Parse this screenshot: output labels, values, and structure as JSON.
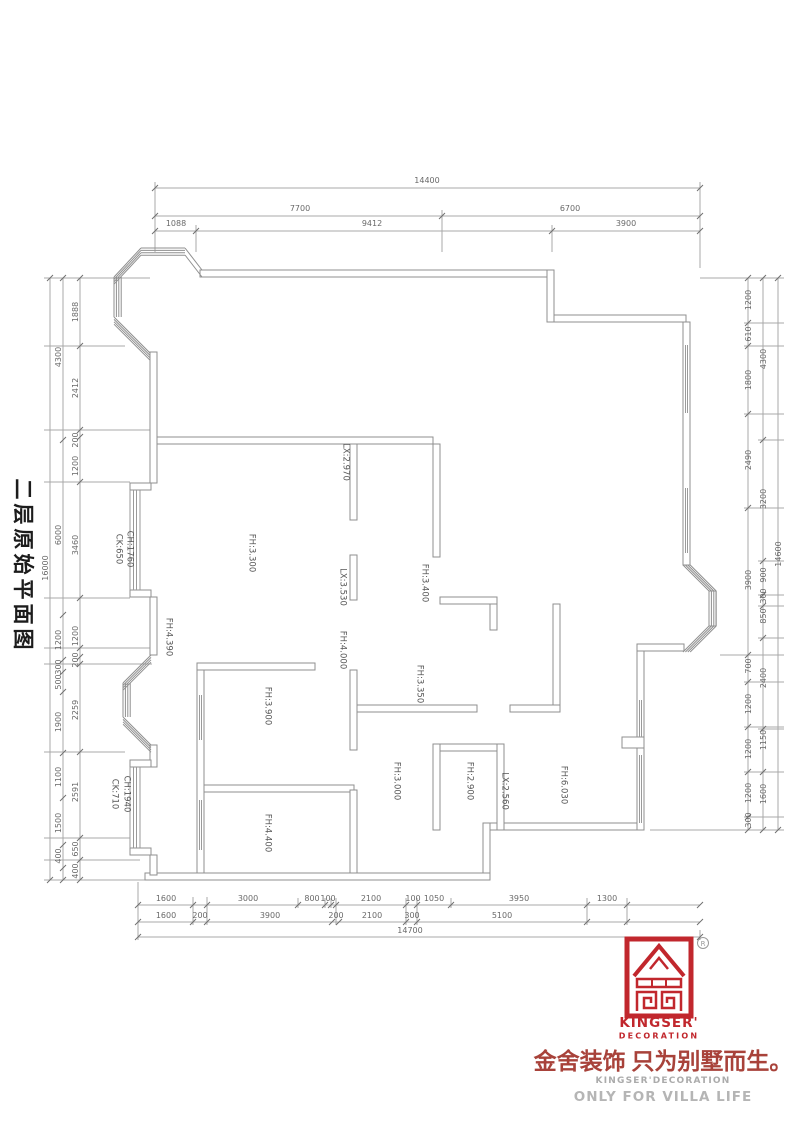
{
  "title": "二层原始平面图",
  "colors": {
    "accent_red": "#c1272d",
    "wall_gray": "#8f8f8f",
    "dim_gray": "#696969"
  },
  "plan": {
    "room_labels": [
      {
        "t": "LX:2.970",
        "x": 345,
        "y": 462
      },
      {
        "t": "FH:3.300",
        "x": 251,
        "y": 553
      },
      {
        "t": "LX:3.530",
        "x": 342,
        "y": 587
      },
      {
        "t": "FH:4.390",
        "x": 168,
        "y": 637
      },
      {
        "t": "FH:4.000",
        "x": 342,
        "y": 650
      },
      {
        "t": "FH:3.400",
        "x": 424,
        "y": 583
      },
      {
        "t": "FH:3.350",
        "x": 419,
        "y": 684
      },
      {
        "t": "FH:3.900",
        "x": 267,
        "y": 706
      },
      {
        "t": "FH:3.000",
        "x": 396,
        "y": 781
      },
      {
        "t": "FH:2.900",
        "x": 469,
        "y": 781
      },
      {
        "t": "FH:4.400",
        "x": 267,
        "y": 833
      },
      {
        "t": "LX:2.560",
        "x": 504,
        "y": 791
      },
      {
        "t": "FH:6.030",
        "x": 563,
        "y": 785
      },
      {
        "t": "CH:1760",
        "x": 129,
        "y": 549
      },
      {
        "t": "CK:650",
        "x": 118,
        "y": 549
      },
      {
        "t": "CH:1940",
        "x": 126,
        "y": 794
      },
      {
        "t": "CK:710",
        "x": 114,
        "y": 794
      }
    ],
    "dimensions": [
      {
        "t": "14400",
        "x": 427,
        "y": 181,
        "o": "h"
      },
      {
        "t": "7700",
        "x": 300,
        "y": 209,
        "o": "h"
      },
      {
        "t": "6700",
        "x": 570,
        "y": 209,
        "o": "h"
      },
      {
        "t": "1088",
        "x": 176,
        "y": 224,
        "o": "h"
      },
      {
        "t": "9412",
        "x": 372,
        "y": 224,
        "o": "h"
      },
      {
        "t": "3900",
        "x": 626,
        "y": 224,
        "o": "h"
      },
      {
        "t": "1600",
        "x": 166,
        "y": 899,
        "o": "h"
      },
      {
        "t": "3000",
        "x": 248,
        "y": 899,
        "o": "h"
      },
      {
        "t": "800",
        "x": 312,
        "y": 899,
        "o": "h"
      },
      {
        "t": "100",
        "x": 328,
        "y": 899,
        "o": "h"
      },
      {
        "t": "2100",
        "x": 371,
        "y": 899,
        "o": "h"
      },
      {
        "t": "100",
        "x": 413,
        "y": 899,
        "o": "h"
      },
      {
        "t": "1050",
        "x": 434,
        "y": 899,
        "o": "h"
      },
      {
        "t": "3950",
        "x": 519,
        "y": 899,
        "o": "h"
      },
      {
        "t": "1300",
        "x": 607,
        "y": 899,
        "o": "h"
      },
      {
        "t": "1600",
        "x": 166,
        "y": 916,
        "o": "h"
      },
      {
        "t": "200",
        "x": 200,
        "y": 916,
        "o": "h"
      },
      {
        "t": "3900",
        "x": 270,
        "y": 916,
        "o": "h"
      },
      {
        "t": "200",
        "x": 336,
        "y": 916,
        "o": "h"
      },
      {
        "t": "2100",
        "x": 372,
        "y": 916,
        "o": "h"
      },
      {
        "t": "300",
        "x": 412,
        "y": 916,
        "o": "h"
      },
      {
        "t": "5100",
        "x": 502,
        "y": 916,
        "o": "h"
      },
      {
        "t": "14700",
        "x": 410,
        "y": 931,
        "o": "h"
      },
      {
        "t": "16000",
        "x": 46,
        "y": 568,
        "o": "v"
      },
      {
        "t": "4300",
        "x": 59,
        "y": 357,
        "o": "v"
      },
      {
        "t": "6000",
        "x": 59,
        "y": 535,
        "o": "v"
      },
      {
        "t": "1200",
        "x": 59,
        "y": 640,
        "o": "v"
      },
      {
        "t": "300",
        "x": 59,
        "y": 667,
        "o": "v"
      },
      {
        "t": "500",
        "x": 59,
        "y": 682,
        "o": "v"
      },
      {
        "t": "1900",
        "x": 59,
        "y": 722,
        "o": "v"
      },
      {
        "t": "1100",
        "x": 59,
        "y": 777,
        "o": "v"
      },
      {
        "t": "1500",
        "x": 59,
        "y": 823,
        "o": "v"
      },
      {
        "t": "400",
        "x": 59,
        "y": 856,
        "o": "v"
      },
      {
        "t": "1888",
        "x": 76,
        "y": 312,
        "o": "v"
      },
      {
        "t": "2412",
        "x": 76,
        "y": 388,
        "o": "v"
      },
      {
        "t": "200",
        "x": 76,
        "y": 440,
        "o": "v"
      },
      {
        "t": "1200",
        "x": 76,
        "y": 466,
        "o": "v"
      },
      {
        "t": "3460",
        "x": 76,
        "y": 545,
        "o": "v"
      },
      {
        "t": "1200",
        "x": 76,
        "y": 636,
        "o": "v"
      },
      {
        "t": "200",
        "x": 76,
        "y": 660,
        "o": "v"
      },
      {
        "t": "2259",
        "x": 76,
        "y": 710,
        "o": "v"
      },
      {
        "t": "2591",
        "x": 76,
        "y": 792,
        "o": "v"
      },
      {
        "t": "650",
        "x": 76,
        "y": 849,
        "o": "v"
      },
      {
        "t": "400",
        "x": 76,
        "y": 871,
        "o": "v"
      },
      {
        "t": "1200",
        "x": 749,
        "y": 300,
        "o": "v"
      },
      {
        "t": "610",
        "x": 749,
        "y": 334,
        "o": "v"
      },
      {
        "t": "1800",
        "x": 749,
        "y": 380,
        "o": "v"
      },
      {
        "t": "2490",
        "x": 749,
        "y": 460,
        "o": "v"
      },
      {
        "t": "3900",
        "x": 749,
        "y": 580,
        "o": "v"
      },
      {
        "t": "700",
        "x": 749,
        "y": 666,
        "o": "v"
      },
      {
        "t": "1200",
        "x": 749,
        "y": 704,
        "o": "v"
      },
      {
        "t": "1200",
        "x": 749,
        "y": 749,
        "o": "v"
      },
      {
        "t": "1200",
        "x": 749,
        "y": 793,
        "o": "v"
      },
      {
        "t": "300",
        "x": 749,
        "y": 820,
        "o": "v"
      },
      {
        "t": "4300",
        "x": 764,
        "y": 359,
        "o": "v"
      },
      {
        "t": "3200",
        "x": 764,
        "y": 499,
        "o": "v"
      },
      {
        "t": "900",
        "x": 764,
        "y": 575,
        "o": "v"
      },
      {
        "t": "300",
        "x": 764,
        "y": 596,
        "o": "v"
      },
      {
        "t": "850",
        "x": 764,
        "y": 616,
        "o": "v"
      },
      {
        "t": "2400",
        "x": 764,
        "y": 678,
        "o": "v"
      },
      {
        "t": "1150",
        "x": 764,
        "y": 740,
        "o": "v"
      },
      {
        "t": "1600",
        "x": 764,
        "y": 794,
        "o": "v"
      },
      {
        "t": "14600",
        "x": 779,
        "y": 554,
        "o": "v"
      }
    ]
  },
  "logo": {
    "reg_mark": "R",
    "brand": "KINGSER'",
    "brand_sub": "DECORATION",
    "slogan_cn": "金舍装饰 只为别墅而生。",
    "slogan_en1": "KINGSER'DECORATION",
    "slogan_en2": "ONLY FOR VILLA LIFE"
  }
}
